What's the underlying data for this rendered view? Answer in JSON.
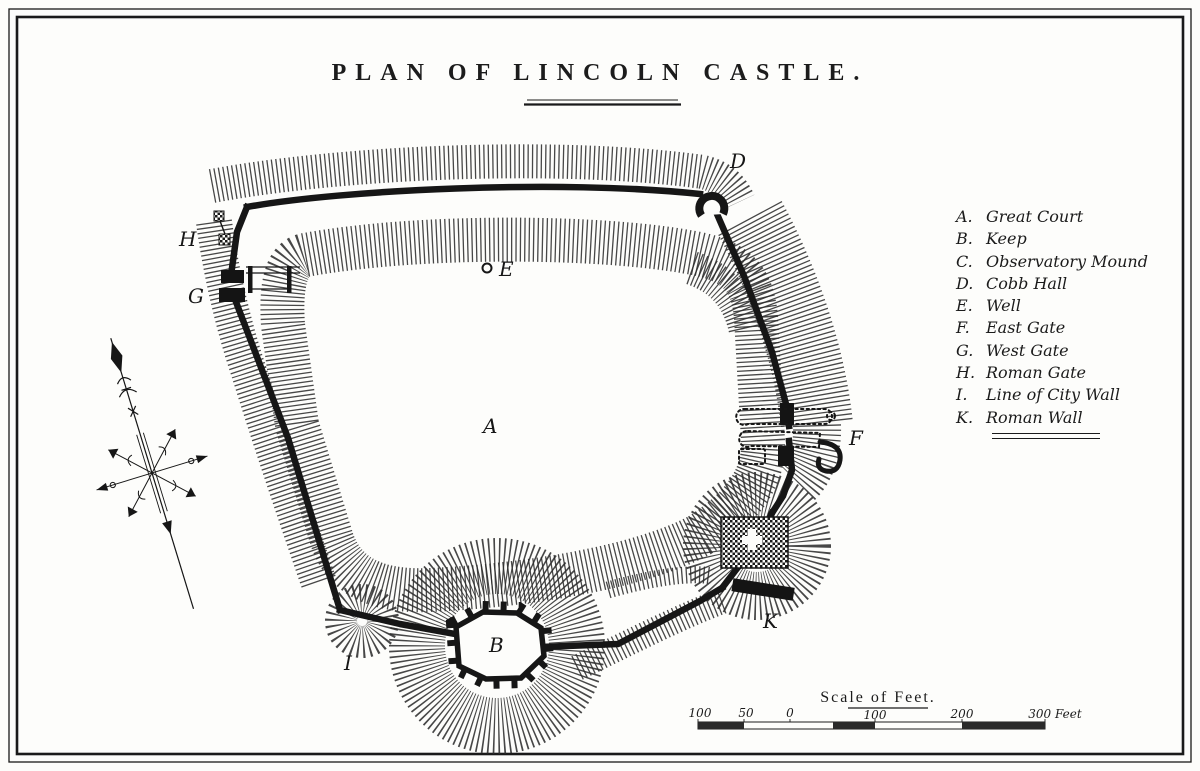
{
  "title": {
    "text": "PLAN OF LINCOLN CASTLE."
  },
  "legend": {
    "items": [
      {
        "letter": "A.",
        "name": "Great Court"
      },
      {
        "letter": "B.",
        "name": "Keep"
      },
      {
        "letter": "C.",
        "name": "Observatory Mound"
      },
      {
        "letter": "D.",
        "name": "Cobb Hall"
      },
      {
        "letter": "E.",
        "name": "Well"
      },
      {
        "letter": "F.",
        "name": "East Gate"
      },
      {
        "letter": "G.",
        "name": "West Gate"
      },
      {
        "letter": "H.",
        "name": "Roman Gate"
      },
      {
        "letter": "I.",
        "name": "Line of City Wall"
      },
      {
        "letter": "K.",
        "name": "Roman Wall"
      }
    ]
  },
  "plan": {
    "A": "A",
    "B": "B",
    "D": "D",
    "E": "E",
    "F": "F",
    "G": "G",
    "H": "H",
    "I": "I",
    "K": "K"
  },
  "scale": {
    "title": "Scale of Feet.",
    "ticks": [
      "100",
      "50",
      "0",
      "100",
      "200",
      "300 Feet"
    ]
  },
  "icons": {
    "compass": "compass-rose",
    "well": "well-circle-marker"
  },
  "colors": {
    "ink": "#1a1a1a",
    "paper": "#fdfdfb",
    "hachure": "#2e2e2e"
  }
}
